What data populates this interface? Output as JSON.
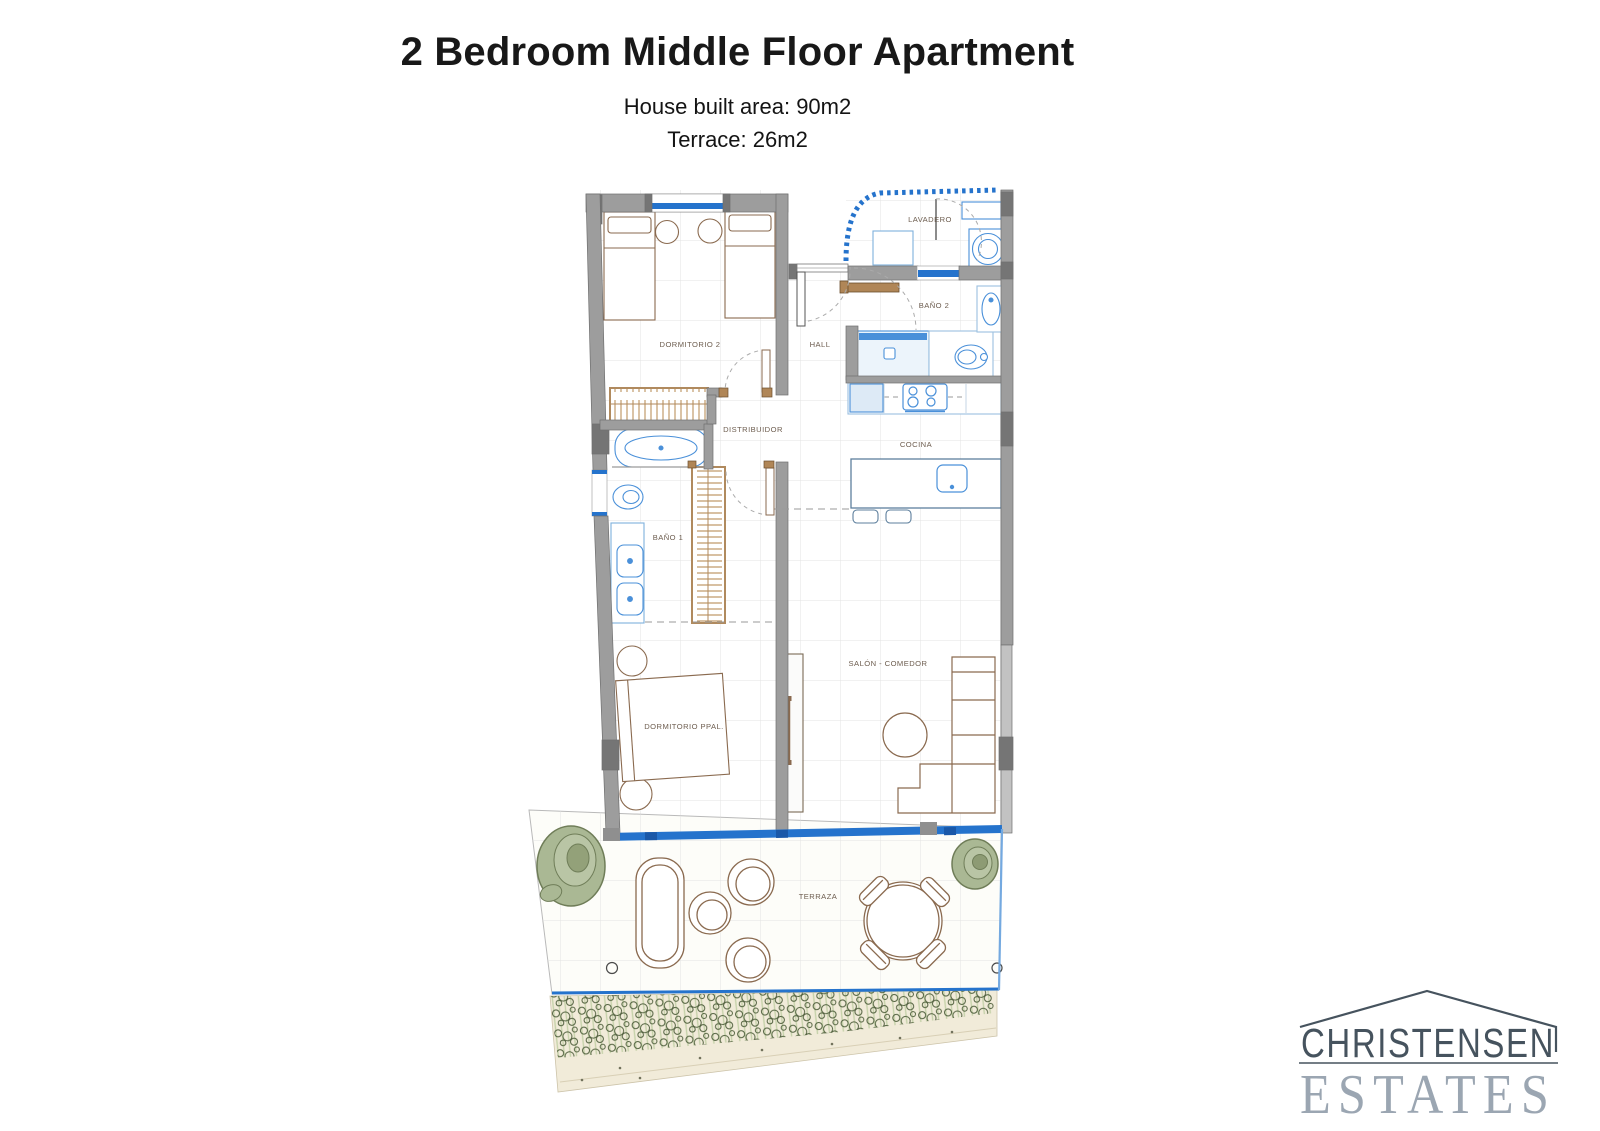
{
  "page": {
    "title": "2 Bedroom Middle Floor Apartment",
    "subtitle_line1": "House built area: 90m2",
    "subtitle_line2": "Terrace: 26m2"
  },
  "plan": {
    "rooms": [
      {
        "id": "lavadero",
        "label": "LAVADERO"
      },
      {
        "id": "bano-2",
        "label": "BAÑO 2"
      },
      {
        "id": "dormitorio-2",
        "label": "DORMITORIO 2"
      },
      {
        "id": "hall",
        "label": "HALL"
      },
      {
        "id": "distribuidor",
        "label": "DISTRIBUIDOR"
      },
      {
        "id": "cocina",
        "label": "COCINA"
      },
      {
        "id": "bano-1",
        "label": "BAÑO 1"
      },
      {
        "id": "salon-comedor",
        "label": "SALÓN - COMEDOR"
      },
      {
        "id": "dormitorio-ppal",
        "label": "DORMITORIO PPAL."
      },
      {
        "id": "terraza",
        "label": "TERRAZA"
      }
    ],
    "colors": {
      "wall_gray": "#9d9d9d",
      "wall_dark": "#757575",
      "window_blue": "#2573cc",
      "fixture_blue": "#4a90d9",
      "furniture_brown": "#8a6a4f",
      "wardrobe_tan": "#b08a5e",
      "label_text": "#6d5d4f",
      "plant_green": "#aab894",
      "vegetation_green": "#4f5f3c",
      "ground_beige": "#f1ebd9",
      "grid_gray": "#e3e3e3"
    }
  },
  "logo": {
    "line1": "CHRISTENSEN",
    "line2": "ESTATES",
    "colors": {
      "primary": "#46535e",
      "secondary": "#9ba6b2"
    }
  }
}
